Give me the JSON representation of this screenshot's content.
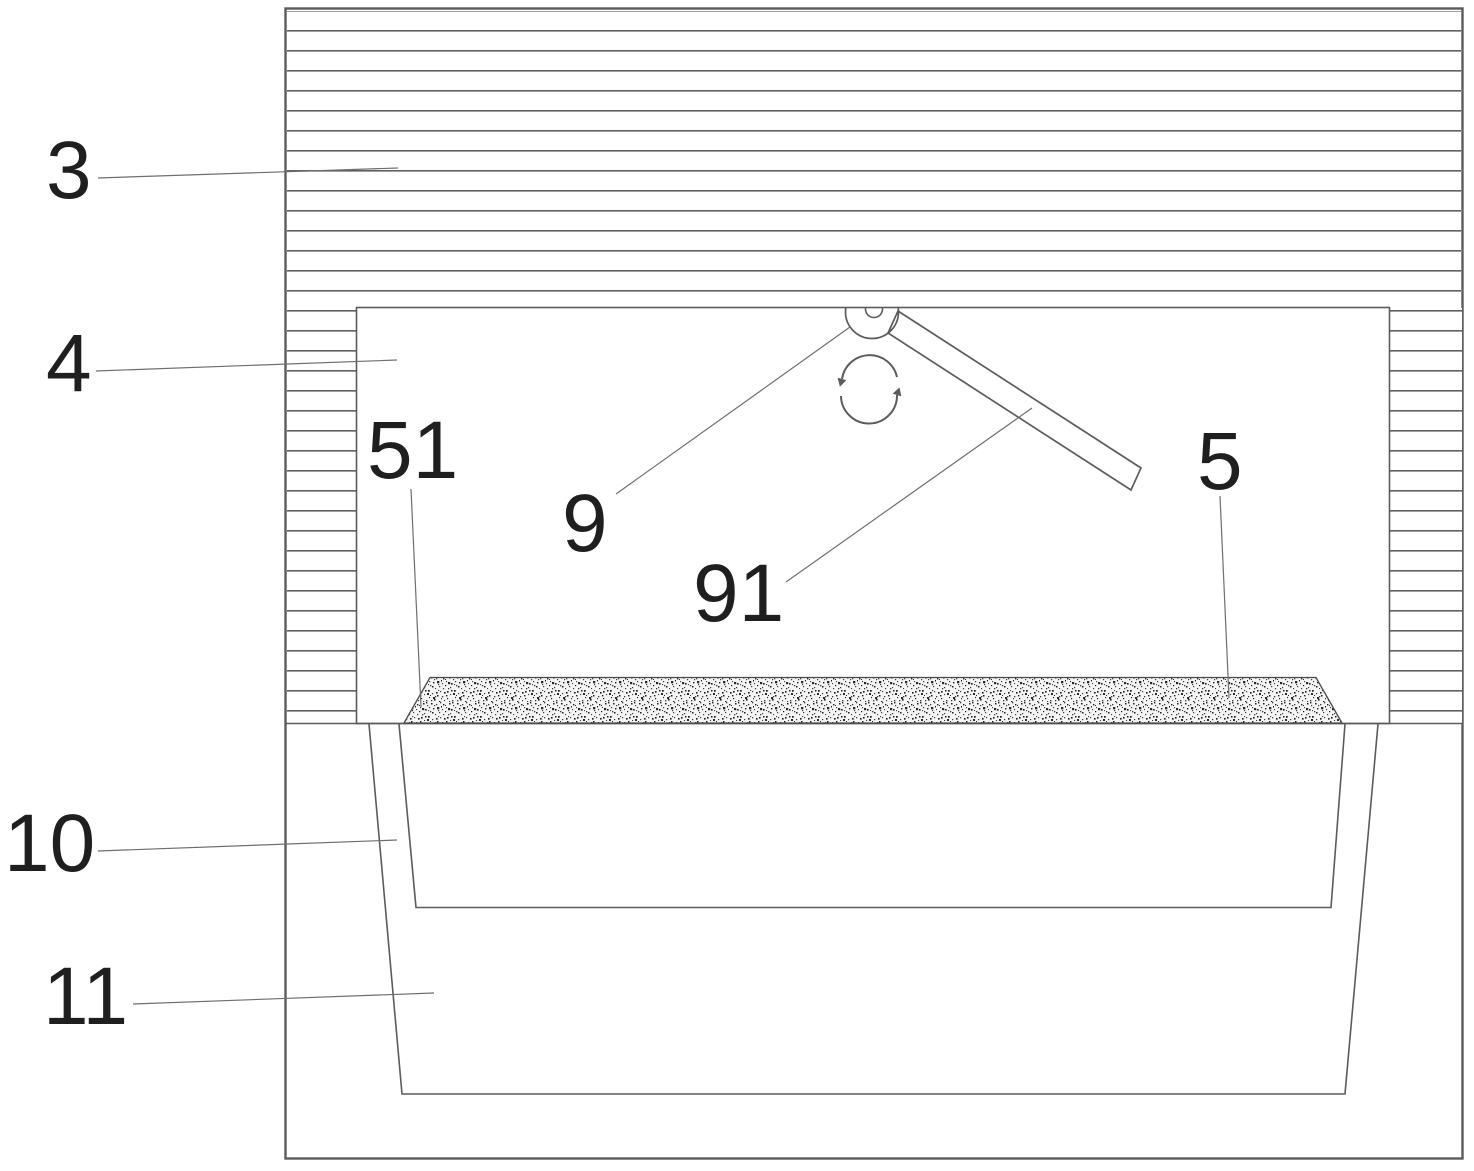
{
  "figure": {
    "title": "patent-style sectional diagram of a hopper and rotary spreader assembly",
    "colors": {
      "background": "#ffffff",
      "line": "#5b5b5b",
      "hatch": "#616161",
      "leader": "#6e6e6e",
      "ink": "#1f1f1f"
    },
    "callouts": [
      {
        "label": "3",
        "tx": 46,
        "ty": 198,
        "x1": 98,
        "y1": 178,
        "x2": 398,
        "y2": 168
      },
      {
        "label": "4",
        "tx": 46,
        "ty": 391,
        "x1": 96,
        "y1": 371,
        "x2": 397,
        "y2": 360
      },
      {
        "label": "51",
        "tx": 367,
        "ty": 478,
        "x1": 411,
        "y1": 489,
        "x2": 421,
        "y2": 707
      },
      {
        "label": "9",
        "tx": 562,
        "ty": 551,
        "x1": 616,
        "y1": 494,
        "x2": 850,
        "y2": 327
      },
      {
        "label": "91",
        "tx": 693,
        "ty": 621,
        "x1": 786,
        "y1": 582,
        "x2": 1032,
        "y2": 408
      },
      {
        "label": "5",
        "tx": 1197,
        "ty": 489,
        "x1": 1220,
        "y1": 496,
        "x2": 1229,
        "y2": 698
      },
      {
        "label": "10",
        "tx": 4,
        "ty": 871,
        "x1": 98,
        "y1": 851,
        "x2": 397,
        "y2": 840
      },
      {
        "label": "11",
        "tx": 43,
        "ty": 1024,
        "x1": 133,
        "y1": 1004,
        "x2": 434,
        "y2": 993
      }
    ]
  }
}
